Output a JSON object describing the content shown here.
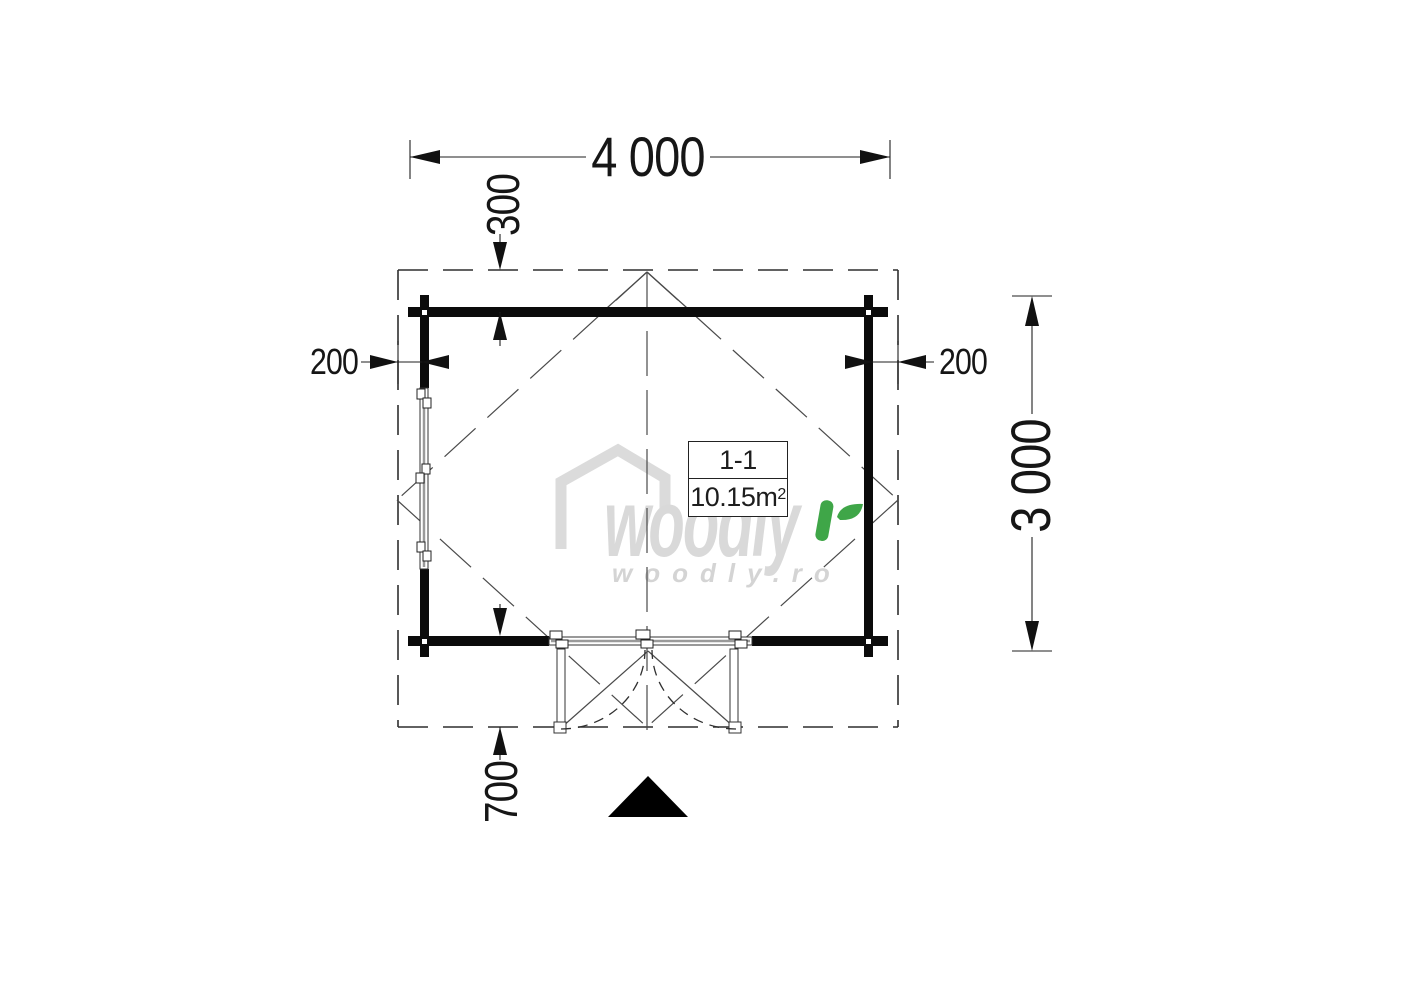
{
  "dimensions": {
    "width_total": "4 000",
    "height_total": "3 000",
    "overhang_top": "300",
    "overhang_left": "200",
    "overhang_right": "200",
    "porch_depth": "700"
  },
  "room": {
    "name": "1-1",
    "area": "10.15m",
    "area_sup": "2"
  },
  "logo": {
    "brand": "woodly",
    "site": "woodly.ro"
  },
  "colors": {
    "background": "#ffffff",
    "wall": "#0b0b0b",
    "thin_line": "#3c3c3c",
    "dimension_line": "#1f1f1f",
    "logo_gray": "#d9d9d9",
    "logo_green": "#3fa648"
  }
}
